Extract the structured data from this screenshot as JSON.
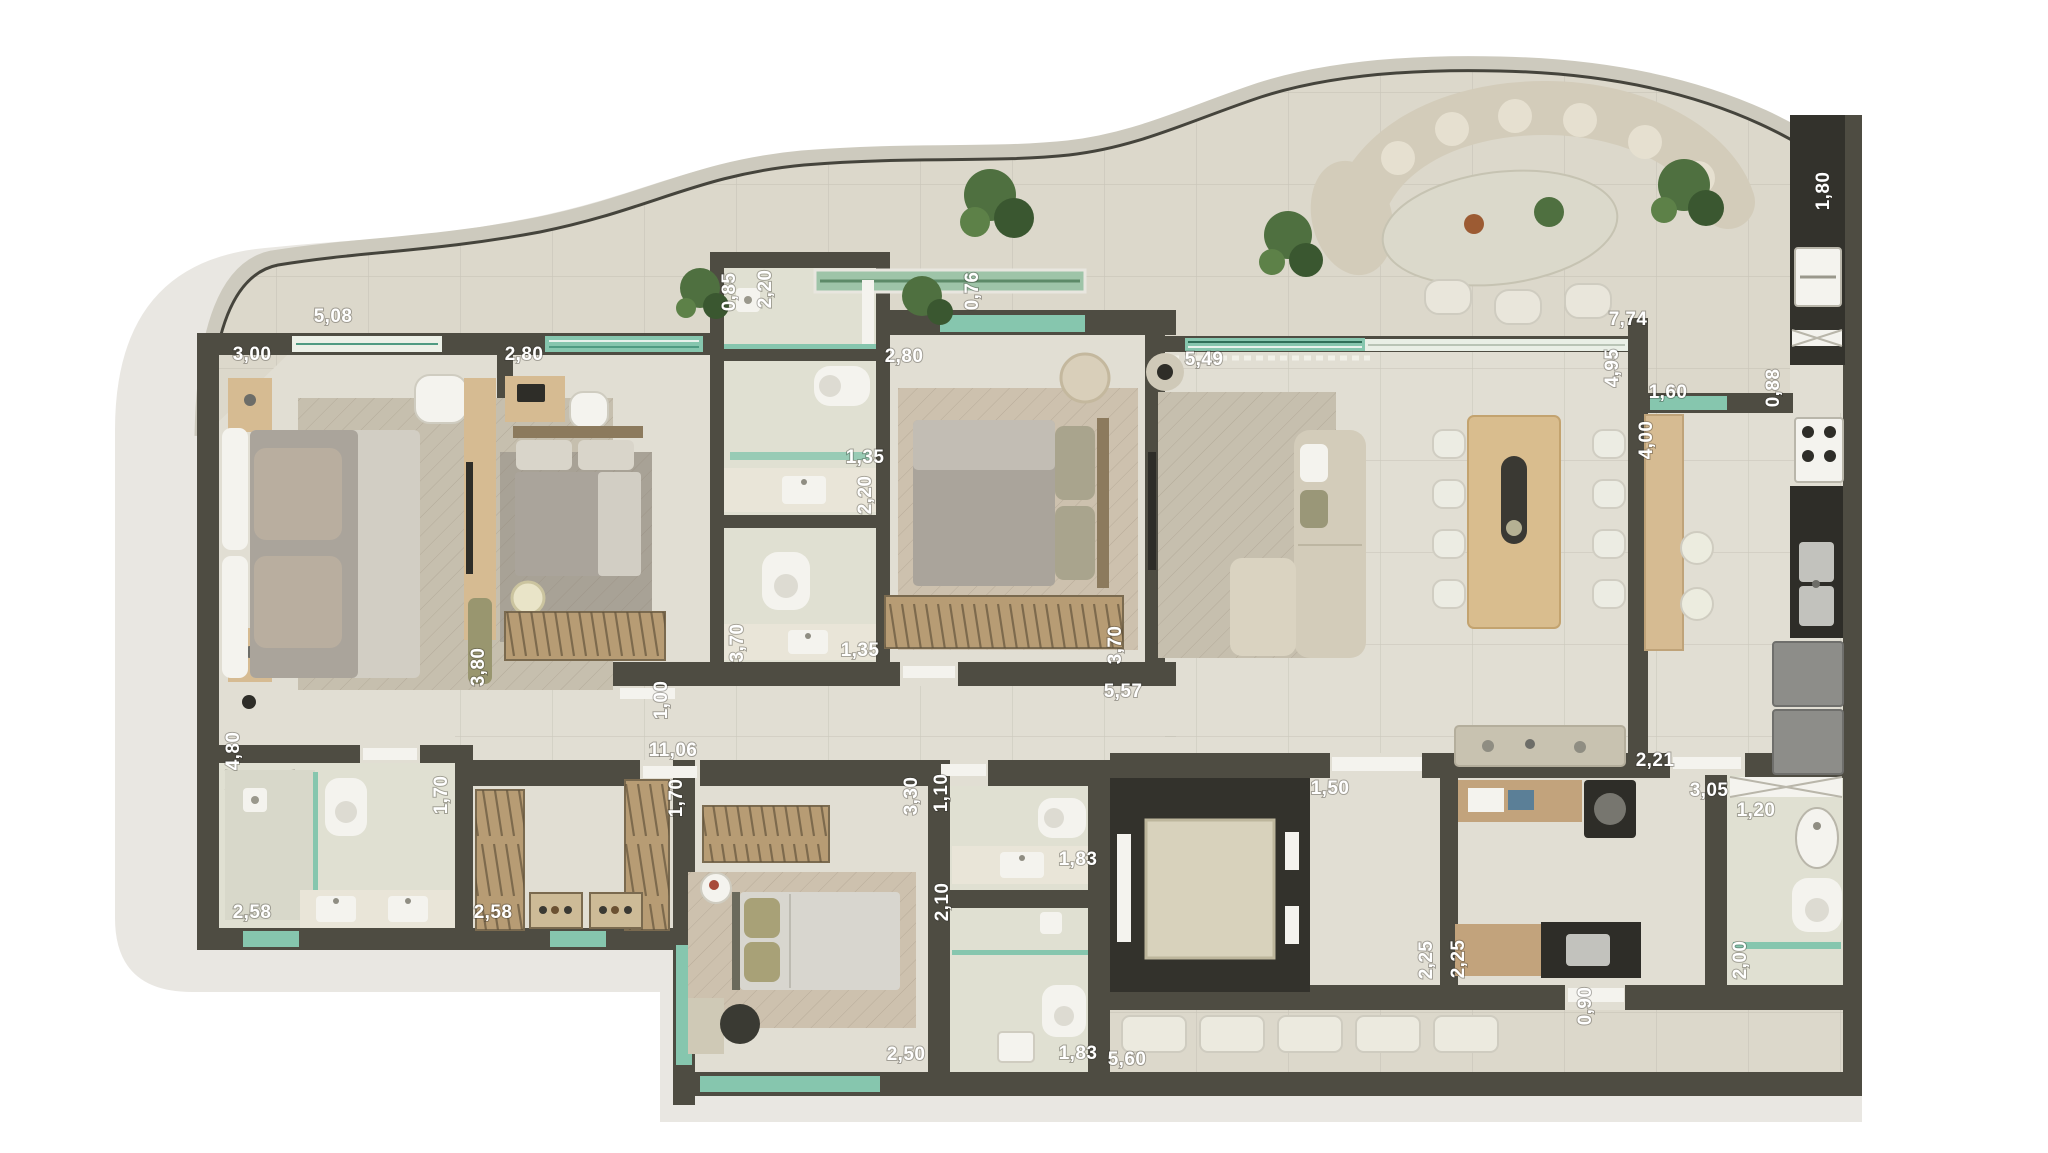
{
  "plan": {
    "kind": "residential apartment floor plan, top-down 3D render",
    "units": "meters (comma decimal)",
    "rooms_visible": [
      "master bedroom",
      "bedroom 2",
      "bedroom 3",
      "bathrooms",
      "corridor",
      "living room",
      "dining area",
      "balcony terrace",
      "kitchen",
      "laundry",
      "service bedroom",
      "closet",
      "elevator hall",
      "service bathroom",
      "service terrace"
    ]
  },
  "colors": {
    "wall": "#4e4c42",
    "wallD": "#33322c",
    "slab": "#e9e7e2",
    "balc": "#dcd8cb",
    "floor": "#e1ded3",
    "bath": "#e0e0d2",
    "rug": "#c6bfae",
    "rugGray": "#a8a296",
    "rugBeige": "#cdc1ae",
    "wood": "#c2a37c",
    "woodL": "#d6bb92",
    "hatch": "#b79c74",
    "white": "#f4f3ee",
    "duvet": "#aaa49b",
    "duvetL": "#d2cec4",
    "olive": "#99966f",
    "sofa": "#d3ccba",
    "teal": "#86c6ae",
    "tealD": "#4f9b82",
    "dark": "#2e2d28",
    "gray": "#8d8d89",
    "plant": "#4f7040",
    "plantD": "#3a5730",
    "label": "#ffffff",
    "parapet": "#cdcabe",
    "parapetL": "#45443c"
  },
  "dimension_labels": [
    {
      "text": "5,08",
      "x": 333,
      "y": 322,
      "rot": 0
    },
    {
      "text": "3,00",
      "x": 252,
      "y": 360,
      "rot": 0
    },
    {
      "text": "2,80",
      "x": 524,
      "y": 360,
      "rot": 0
    },
    {
      "text": "0,85",
      "x": 735,
      "y": 292,
      "rot": -90
    },
    {
      "text": "2,20",
      "x": 771,
      "y": 289,
      "rot": -90
    },
    {
      "text": "0,76",
      "x": 978,
      "y": 291,
      "rot": -90
    },
    {
      "text": "2,80",
      "x": 904,
      "y": 362,
      "rot": 0
    },
    {
      "text": "5,49",
      "x": 1204,
      "y": 365,
      "rot": 0
    },
    {
      "text": "7,74",
      "x": 1628,
      "y": 325,
      "rot": 0
    },
    {
      "text": "4,95",
      "x": 1618,
      "y": 368,
      "rot": -90
    },
    {
      "text": "1,80",
      "x": 1829,
      "y": 191,
      "rot": -90
    },
    {
      "text": "1,60",
      "x": 1668,
      "y": 398,
      "rot": 0
    },
    {
      "text": "0,88",
      "x": 1779,
      "y": 388,
      "rot": -90
    },
    {
      "text": "4,00",
      "x": 1652,
      "y": 440,
      "rot": -90
    },
    {
      "text": "3,80",
      "x": 484,
      "y": 667,
      "rot": -90
    },
    {
      "text": "3,70",
      "x": 743,
      "y": 643,
      "rot": -90
    },
    {
      "text": "1,35",
      "x": 860,
      "y": 656,
      "rot": 0
    },
    {
      "text": "2,20",
      "x": 871,
      "y": 495,
      "rot": -90
    },
    {
      "text": "1,35",
      "x": 865,
      "y": 463,
      "rot": 0
    },
    {
      "text": "3,70",
      "x": 1121,
      "y": 645,
      "rot": -90
    },
    {
      "text": "5,57",
      "x": 1123,
      "y": 697,
      "rot": 0
    },
    {
      "text": "1,00",
      "x": 667,
      "y": 700,
      "rot": -90
    },
    {
      "text": "11,06",
      "x": 673,
      "y": 756,
      "rot": 0
    },
    {
      "text": "4,80",
      "x": 239,
      "y": 751,
      "rot": -90
    },
    {
      "text": "1,70",
      "x": 447,
      "y": 795,
      "rot": -90
    },
    {
      "text": "1,70",
      "x": 682,
      "y": 798,
      "rot": -90
    },
    {
      "text": "2,58",
      "x": 252,
      "y": 918,
      "rot": 0
    },
    {
      "text": "2,58",
      "x": 493,
      "y": 918,
      "rot": 0
    },
    {
      "text": "3,30",
      "x": 917,
      "y": 796,
      "rot": -90
    },
    {
      "text": "1,10",
      "x": 947,
      "y": 793,
      "rot": -90
    },
    {
      "text": "2,10",
      "x": 948,
      "y": 902,
      "rot": -90
    },
    {
      "text": "2,50",
      "x": 906,
      "y": 1060,
      "rot": 0
    },
    {
      "text": "1,83",
      "x": 1078,
      "y": 865,
      "rot": 0
    },
    {
      "text": "1,83",
      "x": 1078,
      "y": 1059,
      "rot": 0
    },
    {
      "text": "1,50",
      "x": 1330,
      "y": 794,
      "rot": 0
    },
    {
      "text": "2,25",
      "x": 1432,
      "y": 960,
      "rot": -90
    },
    {
      "text": "2,25",
      "x": 1464,
      "y": 959,
      "rot": -90
    },
    {
      "text": "5,60",
      "x": 1127,
      "y": 1065,
      "rot": 0
    },
    {
      "text": "2,21",
      "x": 1655,
      "y": 766,
      "rot": 0
    },
    {
      "text": "3,05",
      "x": 1709,
      "y": 796,
      "rot": 0
    },
    {
      "text": "1,20",
      "x": 1756,
      "y": 816,
      "rot": 0
    },
    {
      "text": "2,00",
      "x": 1746,
      "y": 960,
      "rot": -90
    },
    {
      "text": "0,90",
      "x": 1591,
      "y": 1006,
      "rot": -90
    }
  ]
}
